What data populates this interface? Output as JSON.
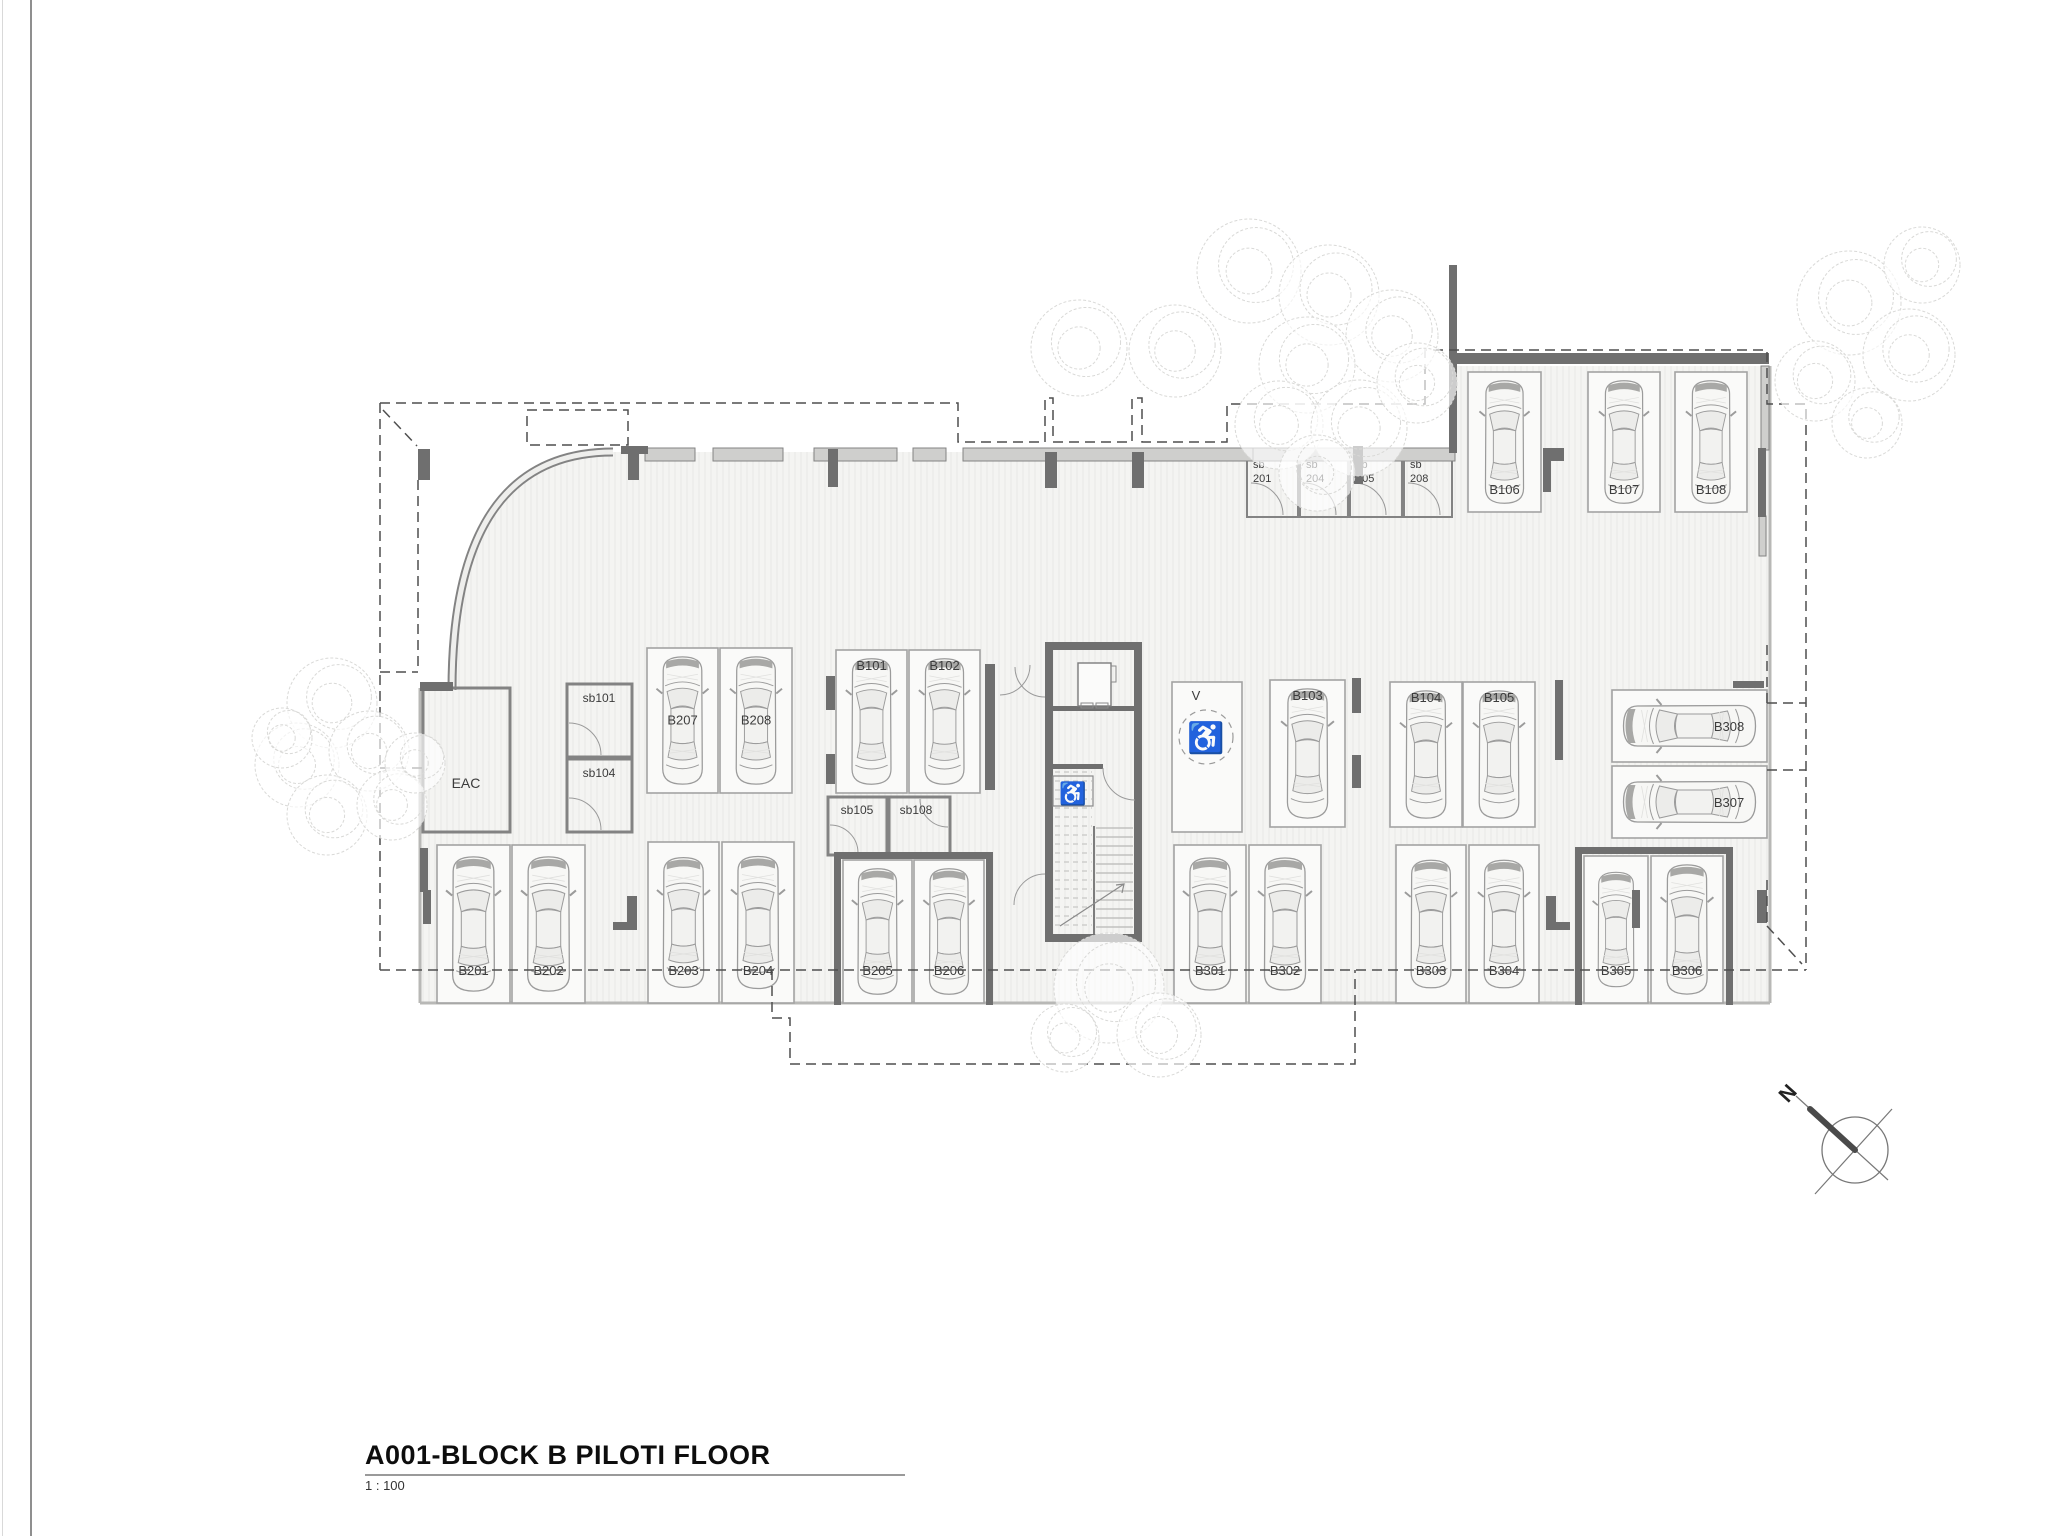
{
  "title_block": {
    "title": "A001-BLOCK B PILOTI FLOOR",
    "scale": "1 : 100"
  },
  "icons": {
    "wheelchair": "♿",
    "north_label": "N"
  },
  "colors": {
    "wall_dark": "#6f6f6f",
    "wall_light_fill": "#cfcfcd",
    "wall_light_stroke": "#838383",
    "slab": "#f4f4f2",
    "hatch": "#e8e8e6",
    "stall_stroke": "#a3a3a3",
    "stall_fill": "#fafaf9",
    "car_stroke": "#9b9b9b",
    "car_fill": "#f7f7f5",
    "car_glass": "#ececea",
    "car_band": "#a8a8a6",
    "label": "#3c3c3c",
    "dashed": "#4f4f4f",
    "tree": "#d9d9d7",
    "slab_edge": "#b8b8b6",
    "door": "#9a9a9a",
    "stair": "#a9a9a7"
  },
  "plan": {
    "slab_path": "M420,1003 L420,688 L452,688 L452,690 Q452,452 613,452 L1455,452 L1455,366 L1770,366 L1770,1003 Z",
    "curve_wall": "M452,690 Q452,452 613,452",
    "slab_edges": [
      [
        420,
        1003,
        1770,
        1003
      ],
      [
        420,
        688,
        420,
        1003
      ],
      [
        1770,
        366,
        1770,
        1003
      ]
    ],
    "walls_light": [
      [
        645,
        448,
        50,
        13
      ],
      [
        713,
        448,
        70,
        13
      ],
      [
        814,
        448,
        83,
        13
      ],
      [
        913,
        448,
        33,
        13
      ],
      [
        963,
        448,
        290,
        13
      ],
      [
        1253,
        448,
        202,
        13
      ],
      [
        1761,
        366,
        8,
        84
      ],
      [
        1759,
        516,
        7,
        40
      ]
    ],
    "walls_dark": [
      [
        418,
        449,
        12,
        31
      ],
      [
        420,
        682,
        33,
        9
      ],
      [
        621,
        446,
        27,
        8
      ],
      [
        628,
        452,
        11,
        28
      ],
      [
        828,
        449,
        10,
        38
      ],
      [
        1045,
        452,
        12,
        36
      ],
      [
        1132,
        452,
        12,
        36
      ],
      [
        1353,
        446,
        10,
        38
      ],
      [
        1449,
        265,
        8,
        188
      ],
      [
        1452,
        353,
        317,
        11
      ],
      [
        1543,
        448,
        8,
        44
      ],
      [
        1543,
        448,
        21,
        13
      ],
      [
        1758,
        448,
        8,
        69
      ],
      [
        985,
        664,
        10,
        126
      ],
      [
        826,
        676,
        9,
        34
      ],
      [
        826,
        754,
        9,
        30
      ],
      [
        1352,
        678,
        9,
        35
      ],
      [
        1352,
        755,
        9,
        33
      ],
      [
        1555,
        680,
        8,
        80
      ],
      [
        1733,
        681,
        31,
        7
      ],
      [
        423,
        890,
        8,
        34
      ],
      [
        420,
        848,
        8,
        44
      ],
      [
        627,
        896,
        10,
        34
      ],
      [
        613,
        922,
        24,
        8
      ],
      [
        834,
        852,
        7,
        153
      ],
      [
        834,
        852,
        158,
        7
      ],
      [
        986,
        852,
        7,
        153
      ],
      [
        1546,
        896,
        10,
        34
      ],
      [
        1546,
        922,
        24,
        8
      ],
      [
        1632,
        890,
        8,
        38
      ],
      [
        1757,
        890,
        10,
        33
      ],
      [
        1575,
        847,
        7,
        158
      ],
      [
        1575,
        847,
        158,
        7
      ],
      [
        1726,
        847,
        7,
        158
      ],
      [
        1045,
        642,
        97,
        8
      ],
      [
        1045,
        642,
        8,
        300
      ],
      [
        1134,
        642,
        8,
        300
      ],
      [
        1045,
        934,
        97,
        8
      ],
      [
        1053,
        706,
        82,
        5
      ],
      [
        1045,
        764,
        58,
        5
      ]
    ],
    "stalls": [
      {
        "id": "B106",
        "x": 1468,
        "y": 372,
        "w": 73,
        "h": 140,
        "lp": "bottom",
        "ly": 494
      },
      {
        "id": "B107",
        "x": 1588,
        "y": 372,
        "w": 72,
        "h": 140,
        "lp": "bottom",
        "ly": 494
      },
      {
        "id": "B108",
        "x": 1675,
        "y": 372,
        "w": 72,
        "h": 140,
        "lp": "bottom",
        "ly": 494
      },
      {
        "id": "B207",
        "x": 647,
        "y": 648,
        "w": 71,
        "h": 145,
        "lp": "mid"
      },
      {
        "id": "B208",
        "x": 720,
        "y": 648,
        "w": 72,
        "h": 145,
        "lp": "mid"
      },
      {
        "id": "B101",
        "x": 836,
        "y": 650,
        "w": 71,
        "h": 143,
        "lp": "top"
      },
      {
        "id": "B102",
        "x": 909,
        "y": 650,
        "w": 71,
        "h": 143,
        "lp": "top"
      },
      {
        "id": "V",
        "x": 1172,
        "y": 682,
        "w": 70,
        "h": 150,
        "lp": "tl",
        "car": false,
        "accessible": true
      },
      {
        "id": "B103",
        "x": 1270,
        "y": 680,
        "w": 75,
        "h": 147,
        "lp": "top"
      },
      {
        "id": "B104",
        "x": 1390,
        "y": 682,
        "w": 72,
        "h": 145,
        "lp": "top"
      },
      {
        "id": "B105",
        "x": 1463,
        "y": 682,
        "w": 72,
        "h": 145,
        "lp": "top"
      },
      {
        "id": "B308",
        "x": 1612,
        "y": 690,
        "w": 155,
        "h": 72,
        "lp": "right",
        "o": "h"
      },
      {
        "id": "B307",
        "x": 1612,
        "y": 766,
        "w": 155,
        "h": 72,
        "lp": "right",
        "o": "h"
      },
      {
        "id": "B201",
        "x": 437,
        "y": 845,
        "w": 73,
        "h": 158,
        "lp": "bottom"
      },
      {
        "id": "B202",
        "x": 512,
        "y": 845,
        "w": 73,
        "h": 158,
        "lp": "bottom"
      },
      {
        "id": "B203",
        "x": 648,
        "y": 842,
        "w": 71,
        "h": 161,
        "lp": "bottom"
      },
      {
        "id": "B204",
        "x": 722,
        "y": 842,
        "w": 72,
        "h": 161,
        "lp": "bottom"
      },
      {
        "id": "B205",
        "x": 843,
        "y": 860,
        "w": 69,
        "h": 143,
        "lp": "bottom"
      },
      {
        "id": "B206",
        "x": 914,
        "y": 860,
        "w": 70,
        "h": 143,
        "lp": "bottom"
      },
      {
        "id": "B301",
        "x": 1174,
        "y": 845,
        "w": 72,
        "h": 158,
        "lp": "bottom"
      },
      {
        "id": "B302",
        "x": 1249,
        "y": 845,
        "w": 72,
        "h": 158,
        "lp": "bottom"
      },
      {
        "id": "B303",
        "x": 1396,
        "y": 845,
        "w": 70,
        "h": 158,
        "lp": "bottom"
      },
      {
        "id": "B304",
        "x": 1469,
        "y": 845,
        "w": 70,
        "h": 158,
        "lp": "bottom"
      },
      {
        "id": "B305",
        "x": 1584,
        "y": 856,
        "w": 64,
        "h": 147,
        "lp": "bottom"
      },
      {
        "id": "B306",
        "x": 1651,
        "y": 856,
        "w": 72,
        "h": 147,
        "lp": "bottom"
      }
    ],
    "rooms": [
      {
        "id": "EAC",
        "label": "EAC",
        "x": 423,
        "y": 688,
        "w": 87,
        "h": 144,
        "lx": 466,
        "ly": 788,
        "fs": 14
      },
      {
        "id": "sb101",
        "label": "sb101",
        "x": 567,
        "y": 684,
        "w": 65,
        "h": 73,
        "lx": 599,
        "ly": 702,
        "fs": 12,
        "door": [
          569,
          755,
          32,
          -90,
          0
        ]
      },
      {
        "id": "sb104",
        "label": "sb104",
        "x": 567,
        "y": 759,
        "w": 65,
        "h": 73,
        "lx": 599,
        "ly": 777,
        "fs": 12,
        "door": [
          569,
          830,
          32,
          -90,
          0
        ]
      },
      {
        "id": "sb105",
        "label": "sb105",
        "x": 828,
        "y": 797,
        "w": 59,
        "h": 58,
        "lx": 857,
        "ly": 814,
        "fs": 12,
        "door": [
          830,
          853,
          28,
          -90,
          0
        ]
      },
      {
        "id": "sb108",
        "label": "sb108",
        "x": 889,
        "y": 797,
        "w": 61,
        "h": 58,
        "lx": 916,
        "ly": 814,
        "fs": 12,
        "door": [
          948,
          799,
          28,
          90,
          180
        ]
      },
      {
        "id": "sb201",
        "label": "sb\n201",
        "x": 1247,
        "y": 455,
        "w": 51,
        "h": 62,
        "lx": 1253,
        "ly": 468,
        "fs": 11,
        "small": true,
        "door": [
          1251,
          515,
          32,
          -90,
          0
        ]
      },
      {
        "id": "sb204",
        "label": "sb\n204",
        "x": 1300,
        "y": 455,
        "w": 48,
        "h": 62,
        "lx": 1306,
        "ly": 468,
        "fs": 11,
        "small": true,
        "door": [
          1304,
          515,
          32,
          -90,
          0
        ]
      },
      {
        "id": "sb205",
        "label": "sb\n205",
        "x": 1350,
        "y": 455,
        "w": 52,
        "h": 62,
        "lx": 1356,
        "ly": 468,
        "fs": 11,
        "small": true,
        "door": [
          1354,
          515,
          32,
          -90,
          0
        ]
      },
      {
        "id": "sb208",
        "label": "sb\n208",
        "x": 1404,
        "y": 455,
        "w": 48,
        "h": 62,
        "lx": 1410,
        "ly": 468,
        "fs": 11,
        "small": true,
        "door": [
          1408,
          515,
          32,
          -90,
          0
        ]
      }
    ],
    "doors": [
      [
        1045,
        667,
        30,
        90,
        180
      ],
      [
        1045,
        905,
        31,
        180,
        270
      ],
      [
        1135,
        768,
        32,
        90,
        180
      ],
      [
        1000,
        665,
        30,
        0,
        90
      ]
    ],
    "dashed_polylines": [
      [
        [
          380,
          403
        ],
        [
          958,
          403
        ],
        [
          958,
          442
        ],
        [
          1045,
          442
        ],
        [
          1045,
          398
        ],
        [
          1053,
          398
        ],
        [
          1053,
          442
        ],
        [
          1132,
          442
        ],
        [
          1132,
          398
        ],
        [
          1142,
          398
        ],
        [
          1142,
          442
        ],
        [
          1227,
          442
        ],
        [
          1227,
          404
        ],
        [
          1425,
          404
        ],
        [
          1425,
          350
        ],
        [
          1767,
          350
        ],
        [
          1767,
          404
        ],
        [
          1806,
          404
        ],
        [
          1806,
          970
        ]
      ],
      [
        [
          380,
          403
        ],
        [
          380,
          970
        ]
      ],
      [
        [
          380,
          672
        ],
        [
          418,
          672
        ]
      ],
      [
        [
          418,
          480
        ],
        [
          418,
          672
        ]
      ],
      [
        [
          380,
          768
        ],
        [
          423,
          768
        ]
      ],
      [
        [
          383,
          410
        ],
        [
          417,
          446
        ]
      ],
      [
        [
          380,
          970
        ],
        [
          1806,
          970
        ]
      ],
      [
        [
          772,
          970
        ],
        [
          772,
          1018
        ],
        [
          790,
          1018
        ],
        [
          790,
          1064
        ],
        [
          1355,
          1064
        ],
        [
          1355,
          970
        ]
      ],
      [
        [
          1767,
          645
        ],
        [
          1767,
          703
        ]
      ],
      [
        [
          1767,
          703
        ],
        [
          1806,
          703
        ]
      ],
      [
        [
          1767,
          770
        ],
        [
          1806,
          770
        ]
      ],
      [
        [
          1767,
          880
        ],
        [
          1767,
          926
        ]
      ],
      [
        [
          1767,
          926
        ],
        [
          1802,
          964
        ]
      ]
    ],
    "dashed_rects": [
      [
        527,
        410,
        101,
        35
      ]
    ],
    "trees": [
      [
        1082,
        345,
        48
      ],
      [
        1178,
        348,
        46
      ],
      [
        1252,
        268,
        52
      ],
      [
        1332,
        292,
        50
      ],
      [
        1395,
        333,
        46
      ],
      [
        1310,
        362,
        48
      ],
      [
        1282,
        422,
        44
      ],
      [
        1362,
        425,
        48
      ],
      [
        1420,
        380,
        40
      ],
      [
        1320,
        470,
        38
      ],
      [
        1852,
        300,
        52
      ],
      [
        1912,
        352,
        46
      ],
      [
        1818,
        378,
        40
      ],
      [
        1925,
        262,
        38
      ],
      [
        1870,
        420,
        35
      ],
      [
        335,
        700,
        45
      ],
      [
        300,
        762,
        42
      ],
      [
        372,
        748,
        40
      ],
      [
        330,
        812,
        40
      ],
      [
        395,
        802,
        35
      ],
      [
        285,
        735,
        30
      ],
      [
        418,
        760,
        30
      ],
      [
        1112,
        985,
        55
      ],
      [
        1162,
        1032,
        42
      ],
      [
        1068,
        1035,
        34
      ]
    ],
    "elevator": {
      "shaft": [
        1053,
        650,
        82,
        56
      ],
      "cab": [
        1078,
        663,
        33,
        43
      ],
      "marks": [
        [
          1081,
          703,
          12,
          5
        ],
        [
          1096,
          703,
          12,
          5
        ],
        [
          1111,
          666,
          5,
          16
        ]
      ]
    },
    "stairs": {
      "divider": [
        1094,
        826,
        1094,
        934
      ],
      "solid": [
        1096,
        1133,
        828,
        930,
        9
      ],
      "dashed": [
        1055,
        1092,
        772,
        930,
        9
      ],
      "arrow": [
        [
          1060,
          926
        ],
        [
          1124,
          884
        ]
      ],
      "wc_box": [
        1053,
        776,
        40,
        30
      ],
      "wc_pos": [
        1073,
        801
      ]
    },
    "accessible_symbol": {
      "circle": [
        1206,
        737,
        27
      ],
      "glyph_pos": [
        1206,
        748
      ]
    },
    "north_arrow": {
      "cx": 1855,
      "cy": 1150,
      "r": 33,
      "line1": [
        1796,
        1096,
        1888,
        1180
      ],
      "line2": [
        1815,
        1194,
        1892,
        1109
      ],
      "needle": [
        1855,
        1150,
        1810,
        1109
      ],
      "label_pos": [
        1793,
        1098
      ],
      "label_rot": -48
    }
  }
}
